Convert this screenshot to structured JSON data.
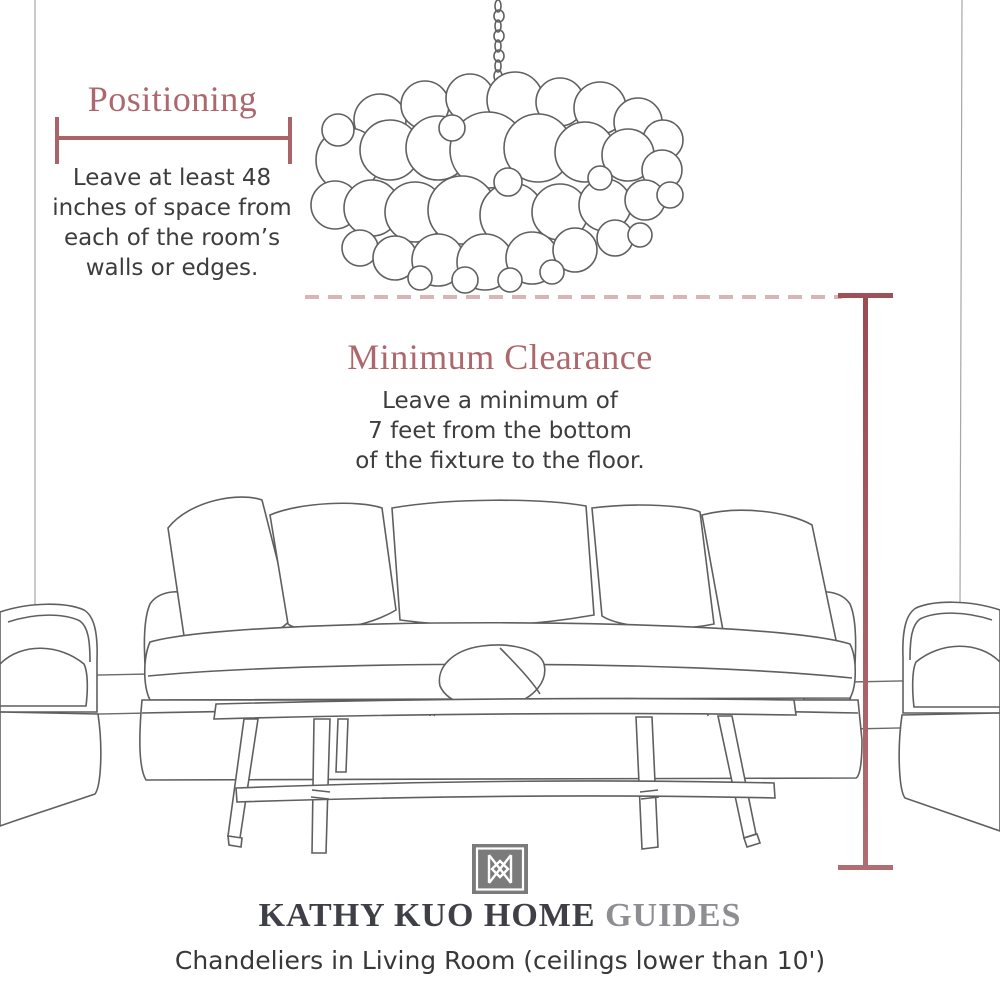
{
  "positioning": {
    "title": "Positioning",
    "lines": {
      "0": "Leave at least 48",
      "1": "inches of space from",
      "2": "each of the room’s",
      "3": "walls or edges."
    }
  },
  "clearance": {
    "title": "Minimum Clearance",
    "lines": {
      "0": "Leave a minimum of",
      "1": "7 feet from the bottom",
      "2": "of the fixture to the floor."
    }
  },
  "footer": {
    "brand": "KATHY KUO HOME",
    "brand_suffix": "GUIDES",
    "caption": "Chandeliers in Living Room (ceilings lower than 10')"
  },
  "illustrations": {
    "chandelier": "bubble-chandelier line sketch hanging from chain",
    "sofa": "slipcovered sofa with five back pillows and lumbar pillow",
    "coffee_table": "long bench coffee table with lower shelf",
    "armchair_left": "partial armchair at left edge",
    "armchair_right": "partial armchair at right edge"
  },
  "colors": {
    "heading_rose": "#ad686e",
    "dimension_line": "#a9646a",
    "dashed_line": "#dab4b7",
    "measure_line_dark": "#9d5156",
    "measure_line_light": "#b06d72",
    "body_text": "#3d3d3d",
    "sketch_stroke": "#5f5f5f",
    "logo_gray": "#7b7b7b",
    "brand_dark": "#3f3f47",
    "brand_gray": "#8e8e92"
  }
}
